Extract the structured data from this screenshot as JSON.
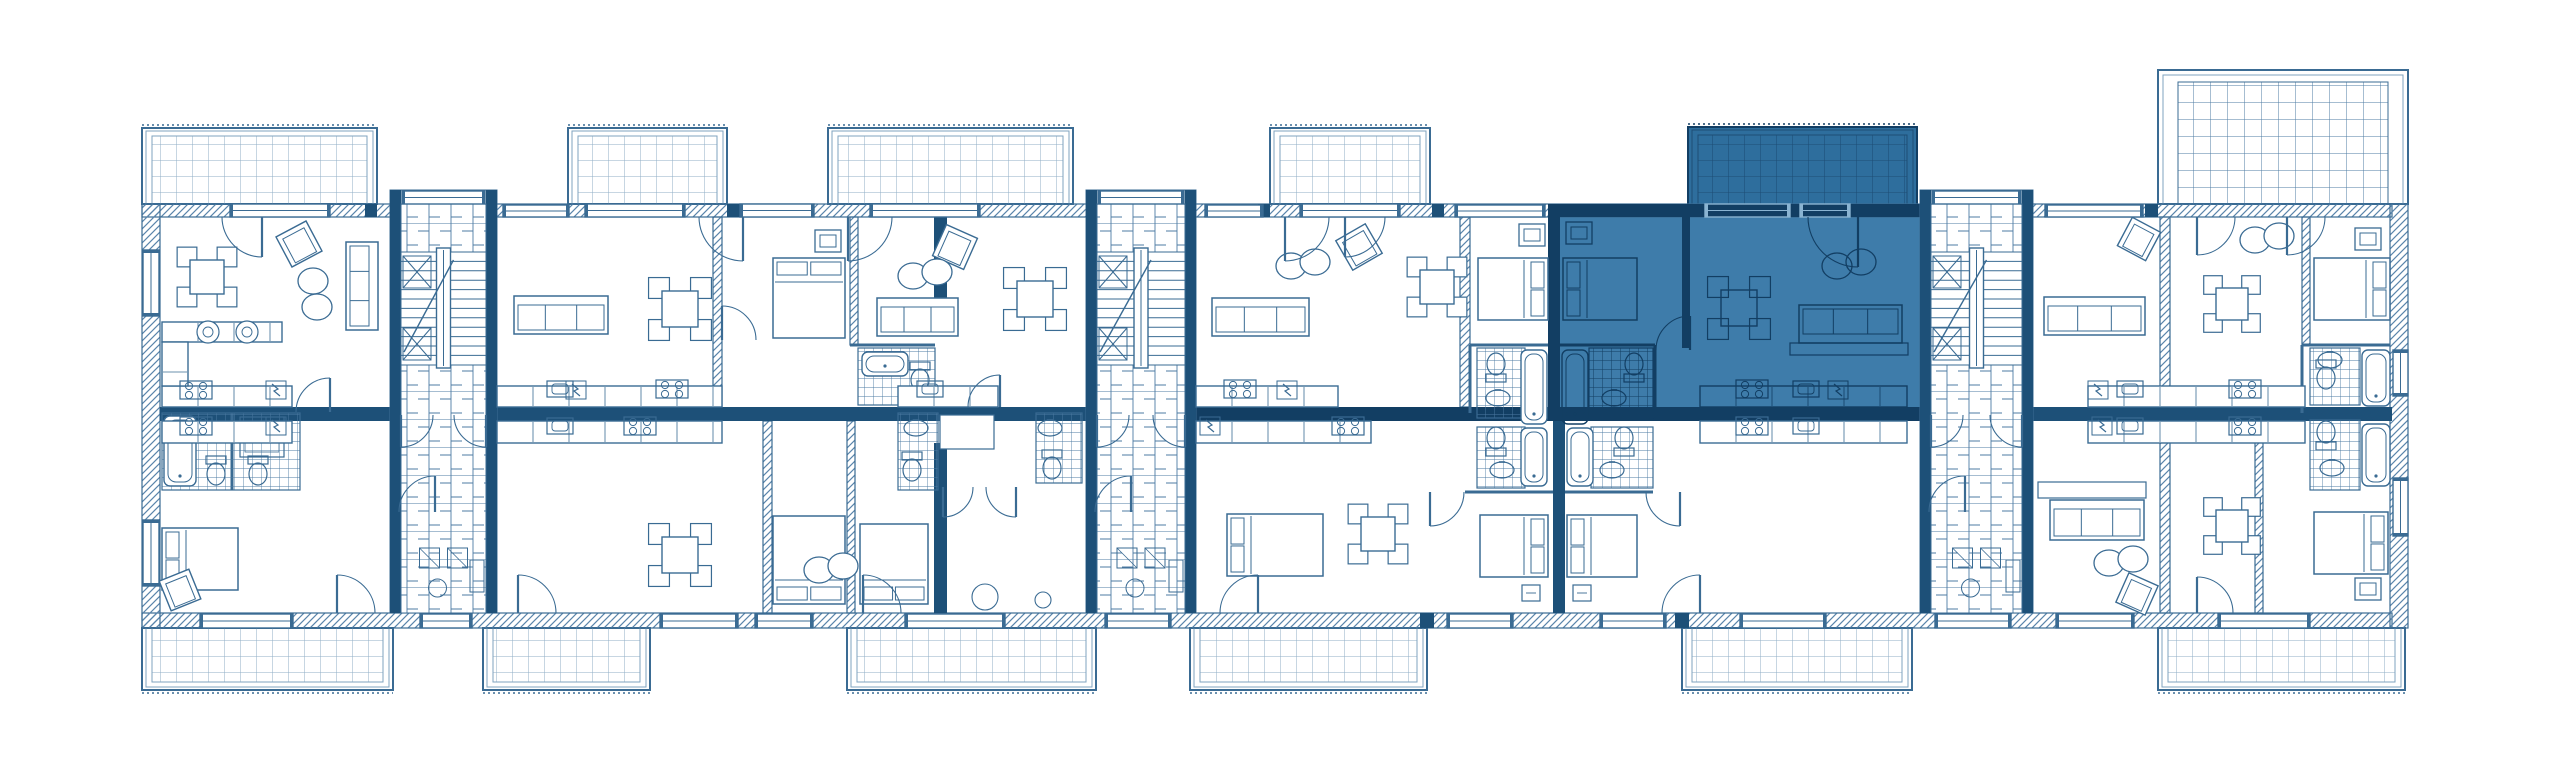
{
  "meta": {
    "kind": "architectural-floor-plan",
    "units_total": 11,
    "highlighted_units": 1
  },
  "palette": {
    "white": "#ffffff",
    "line": "#3a6b93",
    "line_soft": "#7fa3bf",
    "dark": "#1d5078",
    "hatch_line": "#5a85ab",
    "grid_line": "#8fadc5",
    "brick_line": "#4d7ba3",
    "tile_line": "#4d7ba3",
    "hl_fill": "#3e7caa",
    "hl_balcony_fill": "#2e6e9d",
    "hl_grid": "#1d4d75",
    "hl_stroke": "#123e63",
    "hl_window": "#8ab4d2"
  },
  "legend": {
    "rect_format": "[x, y, w, h]",
    "balcony_format": "{x,y,w,h,v: w=white d=dark-highlight}",
    "bed_format": "[x, y, w, h, head-side]",
    "sofa_format": "[x, y, w, h, back-side]",
    "table_format": "[cx, cy, size]",
    "armchair_format": "[cx, cy, size, rotation-deg]",
    "door_format": "[hinge-x, hinge-y, radius, quadrant]",
    "toilet_format": "[cx, cy, rotation-deg]",
    "core_format": "{x,w} stair core, y 190 h 423"
  },
  "plan": {
    "canvas": {
      "w": 2560,
      "h": 779
    },
    "highlight": {
      "room": {
        "x": 1548,
        "y": 204,
        "w": 372,
        "h": 216
      }
    },
    "balconies_top": [
      {
        "x": 142,
        "y": 128,
        "w": 235,
        "h": 76,
        "v": "w"
      },
      {
        "x": 568,
        "y": 128,
        "w": 159,
        "h": 76,
        "v": "w"
      },
      {
        "x": 828,
        "y": 128,
        "w": 245,
        "h": 76,
        "v": "w"
      },
      {
        "x": 1270,
        "y": 128,
        "w": 160,
        "h": 76,
        "v": "w"
      },
      {
        "x": 1688,
        "y": 127,
        "w": 229,
        "h": 78,
        "v": "d"
      }
    ],
    "balconies_bottom": [
      [
        142,
        628,
        251,
        62
      ],
      [
        483,
        628,
        167,
        62
      ],
      [
        847,
        628,
        249,
        62
      ],
      [
        1190,
        628,
        237,
        62
      ],
      [
        1682,
        628,
        230,
        62
      ],
      [
        2158,
        628,
        247,
        62
      ]
    ],
    "terrace": {
      "x": 2158,
      "y": 70,
      "w": 250,
      "h": 134
    },
    "hatch_walls": [
      [
        142,
        204,
        2250,
        13
      ],
      [
        142,
        613,
        2250,
        15
      ],
      [
        142,
        204,
        18,
        424
      ],
      [
        2390,
        204,
        18,
        424
      ],
      [
        713,
        217,
        9,
        190
      ],
      [
        850,
        217,
        8,
        128
      ],
      [
        763,
        421,
        9,
        192
      ],
      [
        847,
        421,
        8,
        192
      ],
      [
        1460,
        217,
        10,
        190
      ],
      [
        2160,
        217,
        10,
        190
      ],
      [
        2160,
        421,
        10,
        192
      ],
      [
        2302,
        217,
        8,
        128
      ],
      [
        2255,
        421,
        8,
        192
      ]
    ],
    "dark_walls": [
      [
        160,
        407,
        230,
        14
      ],
      [
        497,
        407,
        589,
        14
      ],
      [
        1196,
        407,
        724,
        14
      ],
      [
        2033,
        407,
        359,
        14
      ],
      [
        934,
        217,
        13,
        112
      ],
      [
        934,
        443,
        13,
        170
      ],
      [
        1548,
        204,
        12,
        216
      ],
      [
        1553,
        421,
        12,
        192
      ],
      [
        1682,
        217,
        8,
        131
      ],
      [
        1548,
        204,
        372,
        13
      ],
      [
        365,
        204,
        12,
        13
      ],
      [
        727,
        204,
        14,
        13
      ],
      [
        1258,
        204,
        12,
        13
      ],
      [
        1432,
        204,
        12,
        13
      ],
      [
        2145,
        204,
        13,
        13
      ],
      [
        1420,
        613,
        14,
        15
      ],
      [
        1675,
        613,
        14,
        15
      ]
    ],
    "cores": [
      {
        "x": 390,
        "w": 107
      },
      {
        "x": 1086,
        "w": 110
      },
      {
        "x": 1920,
        "w": 113
      }
    ],
    "thin_walls": [
      [
        850,
        345,
        935,
        345
      ],
      [
        1470,
        345,
        1548,
        345
      ],
      [
        1560,
        345,
        1655,
        345
      ],
      [
        2302,
        345,
        2390,
        345
      ],
      [
        1465,
        492,
        1553,
        492
      ],
      [
        1565,
        492,
        1653,
        492
      ],
      [
        1470,
        345,
        1470,
        413
      ],
      [
        1655,
        345,
        1655,
        413
      ],
      [
        232,
        413,
        232,
        490
      ],
      [
        2302,
        345,
        2302,
        413
      ]
    ],
    "bath_tiles": [
      [
        162,
        413,
        138,
        77
      ],
      [
        858,
        348,
        77,
        57
      ],
      [
        898,
        413,
        40,
        77
      ],
      [
        1036,
        413,
        46,
        70
      ],
      [
        1477,
        348,
        48,
        70
      ],
      [
        1589,
        348,
        64,
        70
      ],
      [
        1477,
        427,
        48,
        61
      ],
      [
        1591,
        427,
        62,
        61
      ],
      [
        2310,
        348,
        50,
        57
      ],
      [
        2310,
        420,
        50,
        70
      ]
    ],
    "tubs": [
      [
        164,
        416,
        32,
        70
      ],
      [
        862,
        352,
        46,
        24
      ],
      [
        1521,
        350,
        26,
        74
      ],
      [
        1562,
        350,
        26,
        74
      ],
      [
        1521,
        428,
        26,
        58
      ],
      [
        1567,
        428,
        26,
        58
      ],
      [
        2362,
        350,
        28,
        56
      ],
      [
        2362,
        424,
        28,
        62
      ]
    ],
    "toilets": [
      [
        216,
        472,
        0
      ],
      [
        258,
        472,
        0
      ],
      [
        920,
        378,
        0
      ],
      [
        912,
        468,
        0
      ],
      [
        1052,
        466,
        0
      ],
      [
        1496,
        366,
        180
      ],
      [
        1634,
        366,
        180
      ],
      [
        1496,
        440,
        180
      ],
      [
        1624,
        440,
        180
      ],
      [
        2326,
        376,
        0
      ],
      [
        2326,
        434,
        180
      ]
    ],
    "sinks": [
      [
        222,
        430
      ],
      [
        916,
        428
      ],
      [
        1050,
        428
      ],
      [
        1498,
        398
      ],
      [
        1614,
        398
      ],
      [
        1502,
        470
      ],
      [
        1612,
        470
      ],
      [
        2330,
        360
      ],
      [
        2332,
        468
      ]
    ],
    "showers": [
      [
        240,
        417,
        44,
        40
      ]
    ],
    "boxes": [
      [
        940,
        415,
        54,
        34
      ]
    ],
    "circles": [
      [
        985,
        597,
        13
      ],
      [
        1043,
        600,
        8
      ]
    ],
    "counters": [
      [
        162,
        386,
        130,
        21
      ],
      [
        497,
        386,
        225,
        21
      ],
      [
        898,
        386,
        100,
        21
      ],
      [
        1196,
        386,
        142,
        21
      ],
      [
        1700,
        386,
        207,
        21
      ],
      [
        2088,
        386,
        217,
        21
      ],
      [
        162,
        421,
        130,
        22
      ],
      [
        497,
        421,
        225,
        22
      ],
      [
        1196,
        421,
        175,
        22
      ],
      [
        1700,
        421,
        207,
        22
      ],
      [
        2088,
        421,
        217,
        22
      ],
      [
        162,
        322,
        120,
        20
      ],
      [
        162,
        342,
        26,
        44
      ]
    ],
    "round_sinks": [
      [
        208,
        332
      ],
      [
        247,
        332
      ]
    ],
    "stoves": [
      [
        196,
        390
      ],
      [
        672,
        389
      ],
      [
        1240,
        389
      ],
      [
        1752,
        389
      ],
      [
        2245,
        389
      ],
      [
        196,
        426
      ],
      [
        640,
        426
      ],
      [
        1348,
        426
      ],
      [
        1752,
        426
      ],
      [
        2245,
        426
      ]
    ],
    "ksinks": [
      [
        560,
        389
      ],
      [
        930,
        389
      ],
      [
        1806,
        389
      ],
      [
        2130,
        389
      ],
      [
        560,
        426
      ],
      [
        1806,
        426
      ],
      [
        2130,
        426
      ]
    ],
    "bolts": [
      [
        276,
        390
      ],
      [
        576,
        390
      ],
      [
        1287,
        390
      ],
      [
        1838,
        390
      ],
      [
        2098,
        390
      ],
      [
        276,
        426
      ],
      [
        1210,
        426
      ],
      [
        2102,
        426
      ]
    ],
    "beds": [
      [
        773,
        258,
        72,
        80,
        "top"
      ],
      [
        1478,
        258,
        70,
        62,
        "right"
      ],
      [
        1563,
        258,
        74,
        62,
        "left"
      ],
      [
        2314,
        258,
        76,
        62,
        "right"
      ],
      [
        162,
        528,
        76,
        62,
        "left"
      ],
      [
        773,
        516,
        72,
        88,
        "bottom"
      ],
      [
        860,
        524,
        68,
        80,
        "bottom"
      ],
      [
        1227,
        514,
        96,
        62,
        "left"
      ],
      [
        1480,
        515,
        68,
        62,
        "right"
      ],
      [
        1567,
        515,
        70,
        62,
        "left"
      ],
      [
        2314,
        512,
        74,
        62,
        "right"
      ]
    ],
    "sofas": [
      [
        346,
        242,
        32,
        88,
        "right"
      ],
      [
        514,
        296,
        94,
        38,
        "top"
      ],
      [
        877,
        298,
        81,
        38,
        "top"
      ],
      [
        1212,
        298,
        97,
        38,
        "top"
      ],
      [
        1799,
        305,
        103,
        38,
        "bottom"
      ],
      [
        2044,
        297,
        101,
        38,
        "top"
      ],
      [
        2050,
        500,
        94,
        40,
        "top"
      ]
    ],
    "platforms": [
      [
        1790,
        343,
        118,
        12
      ],
      [
        2038,
        482,
        108,
        16
      ]
    ],
    "tables4": [
      [
        207,
        277,
        34
      ],
      [
        680,
        309,
        36
      ],
      [
        1035,
        299,
        36
      ],
      [
        1437,
        287,
        34
      ],
      [
        1739,
        308,
        36
      ],
      [
        2232,
        304,
        32
      ],
      [
        680,
        555,
        36
      ],
      [
        1378,
        534,
        34
      ],
      [
        2232,
        526,
        32
      ]
    ],
    "armchairs": [
      [
        299,
        244,
        34,
        -28
      ],
      [
        955,
        247,
        34,
        24
      ],
      [
        1359,
        247,
        34,
        -30
      ],
      [
        2139,
        239,
        32,
        28
      ],
      [
        2137,
        594,
        32,
        24
      ],
      [
        180,
        590,
        32,
        -22
      ]
    ],
    "poufs": [
      [
        313,
        294,
        "v"
      ],
      [
        925,
        274,
        "h"
      ],
      [
        1303,
        264,
        "h"
      ],
      [
        1849,
        264,
        "h"
      ],
      [
        2267,
        238,
        "h"
      ],
      [
        2121,
        561,
        "h"
      ],
      [
        831,
        568,
        "h"
      ]
    ],
    "wardrobes": [
      [
        815,
        230
      ],
      [
        1519,
        224
      ],
      [
        1566,
        222
      ],
      [
        2355,
        228
      ],
      [
        2355,
        578
      ]
    ],
    "stools": [
      [
        1522,
        585
      ],
      [
        1573,
        585
      ]
    ],
    "windows": [
      [
        230,
        204,
        100,
        13
      ],
      [
        503,
        205,
        66,
        12
      ],
      [
        585,
        204,
        100,
        13
      ],
      [
        740,
        204,
        74,
        13
      ],
      [
        870,
        204,
        110,
        13
      ],
      [
        1205,
        205,
        58,
        12
      ],
      [
        1300,
        204,
        100,
        13
      ],
      [
        1455,
        205,
        90,
        12
      ],
      [
        1705,
        204,
        85,
        13
      ],
      [
        1800,
        204,
        50,
        13
      ],
      [
        2045,
        205,
        98,
        12
      ],
      [
        402,
        191,
        83,
        13
      ],
      [
        1098,
        191,
        86,
        13
      ],
      [
        1932,
        191,
        89,
        13
      ],
      [
        200,
        614,
        93,
        14
      ],
      [
        420,
        614,
        52,
        14
      ],
      [
        660,
        614,
        78,
        14
      ],
      [
        755,
        614,
        58,
        14
      ],
      [
        905,
        614,
        100,
        14
      ],
      [
        1105,
        614,
        66,
        14
      ],
      [
        1447,
        614,
        66,
        14
      ],
      [
        1600,
        614,
        66,
        14
      ],
      [
        1740,
        614,
        86,
        14
      ],
      [
        1935,
        614,
        76,
        14
      ],
      [
        2056,
        614,
        78,
        14
      ],
      [
        2218,
        614,
        92,
        14
      ],
      [
        143,
        250,
        16,
        66
      ],
      [
        143,
        520,
        16,
        66
      ],
      [
        2393,
        350,
        15,
        46
      ],
      [
        2393,
        478,
        15,
        58
      ]
    ],
    "doors": [
      [
        262,
        217,
        40,
        "sw"
      ],
      [
        743,
        217,
        44,
        "sw"
      ],
      [
        848,
        217,
        44,
        "se"
      ],
      [
        1285,
        217,
        44,
        "se"
      ],
      [
        1345,
        217,
        40,
        "se"
      ],
      [
        1858,
        217,
        50,
        "sw"
      ],
      [
        2197,
        217,
        38,
        "se"
      ],
      [
        2287,
        217,
        38,
        "se"
      ],
      [
        337,
        613,
        38,
        "ne"
      ],
      [
        518,
        613,
        38,
        "ne"
      ],
      [
        863,
        613,
        38,
        "ne"
      ],
      [
        1258,
        613,
        38,
        "nw"
      ],
      [
        1700,
        613,
        38,
        "nw"
      ],
      [
        2197,
        613,
        36,
        "ne"
      ],
      [
        330,
        412,
        34,
        "nw"
      ],
      [
        722,
        340,
        34,
        "ne"
      ],
      [
        1000,
        407,
        32,
        "nw"
      ],
      [
        1690,
        350,
        34,
        "nw"
      ],
      [
        1430,
        492,
        34,
        "se"
      ],
      [
        1680,
        492,
        34,
        "sw"
      ],
      [
        943,
        487,
        30,
        "se"
      ],
      [
        1016,
        487,
        30,
        "sw"
      ]
    ],
    "unit_regions": [
      {
        "id": "apartment-1-upper",
        "x": 160,
        "y": 204,
        "w": 230,
        "h": 203,
        "selected": false
      },
      {
        "id": "apartment-2-upper",
        "x": 497,
        "y": 204,
        "w": 437,
        "h": 203,
        "selected": false
      },
      {
        "id": "apartment-3-upper",
        "x": 947,
        "y": 204,
        "w": 139,
        "h": 203,
        "selected": false
      },
      {
        "id": "apartment-4-upper",
        "x": 1196,
        "y": 204,
        "w": 352,
        "h": 203,
        "selected": false
      },
      {
        "id": "apartment-selected",
        "x": 1548,
        "y": 127,
        "w": 372,
        "h": 294,
        "selected": true
      },
      {
        "id": "apartment-6-upper",
        "x": 2033,
        "y": 70,
        "w": 359,
        "h": 337,
        "selected": false
      },
      {
        "id": "apartment-7-lower",
        "x": 160,
        "y": 421,
        "w": 230,
        "h": 207,
        "selected": false
      },
      {
        "id": "apartment-8-lower",
        "x": 497,
        "y": 421,
        "w": 589,
        "h": 207,
        "selected": false
      },
      {
        "id": "apartment-9-lower",
        "x": 1196,
        "y": 421,
        "w": 352,
        "h": 207,
        "selected": false
      },
      {
        "id": "apartment-10-lower",
        "x": 1548,
        "y": 421,
        "w": 372,
        "h": 207,
        "selected": false
      },
      {
        "id": "apartment-11-lower",
        "x": 2033,
        "y": 421,
        "w": 359,
        "h": 207,
        "selected": false
      }
    ]
  }
}
